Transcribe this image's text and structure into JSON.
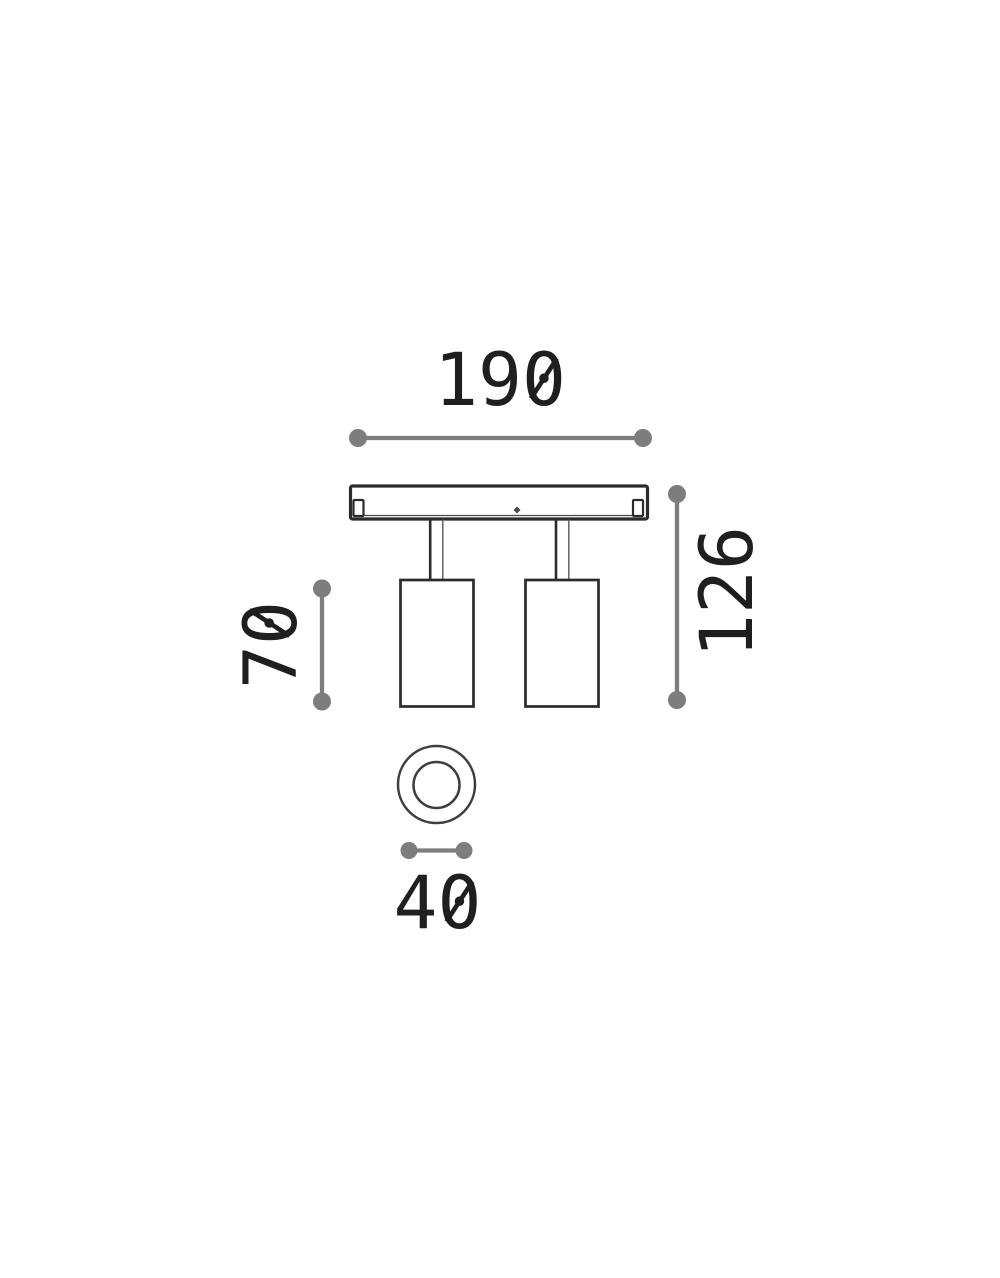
{
  "diagram": {
    "type": "technical-dimension-drawing",
    "subject": "two-head-ceiling-spotlight",
    "views": [
      "front-elevation",
      "bottom-view"
    ]
  },
  "dimensions": {
    "overall_width": "190",
    "overall_height": "126",
    "body_height": "70",
    "head_diameter": "40"
  },
  "colors": {
    "background": "#ffffff",
    "outline": "#2b2b2b",
    "dimension_gray": "#7d7d7d",
    "label_text": "#1f1f1f"
  }
}
